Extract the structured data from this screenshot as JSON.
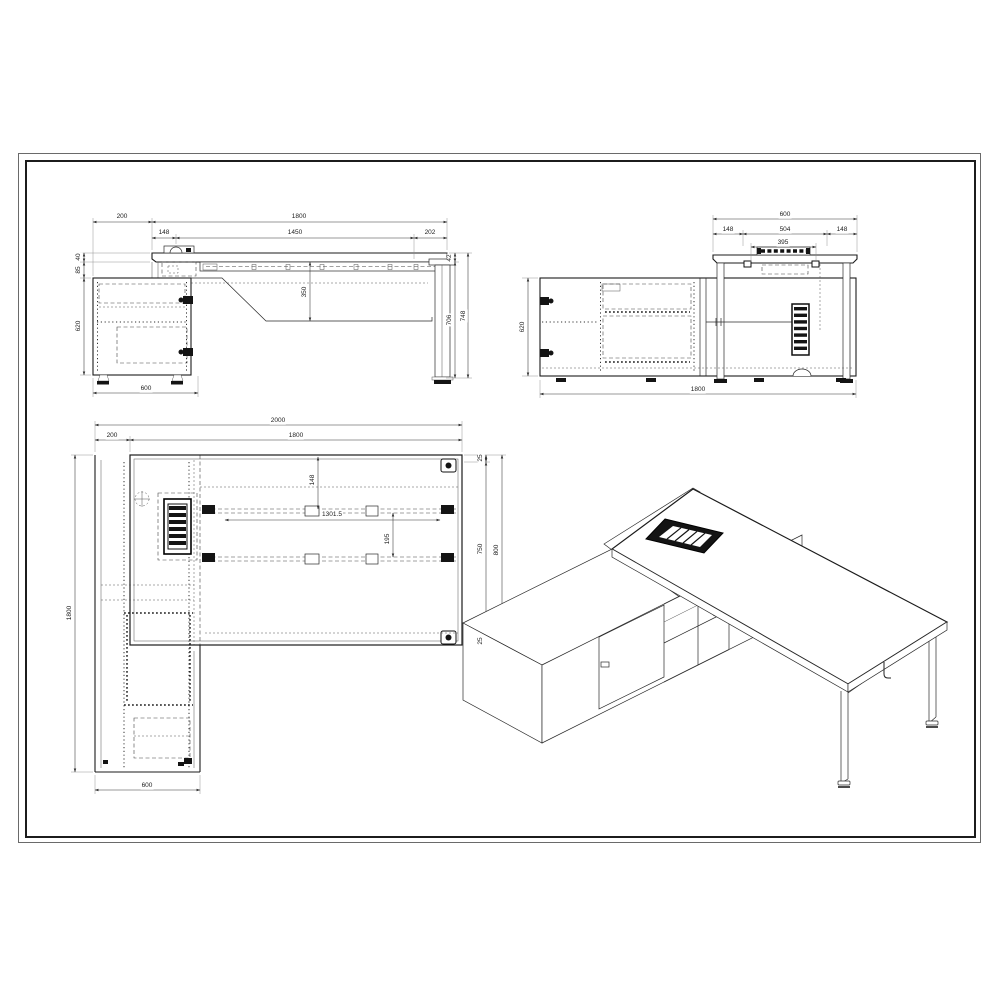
{
  "dims": {
    "front": {
      "offset": "200",
      "length": "1800",
      "seg_a": "148",
      "seg_b": "1450",
      "seg_c": "202",
      "top": "40",
      "gap": "85",
      "cab_height": "620",
      "drop": "350",
      "edge": "42",
      "clearance": "706",
      "height": "748",
      "cab_depth": "600"
    },
    "side": {
      "depth": "600",
      "seg_a": "148",
      "seg_b": "504",
      "seg_c": "148",
      "tray": "395",
      "cab_height": "620",
      "length": "1800"
    },
    "plan": {
      "overall": "2000",
      "offset": "200",
      "length": "1800",
      "inset": "148",
      "rail_length": "1301.5",
      "rail_gap": "195",
      "edge_top": "25",
      "inner": "750",
      "edge_bottom": "25",
      "depth": "800",
      "return_length": "1800",
      "return_depth": "600"
    }
  }
}
